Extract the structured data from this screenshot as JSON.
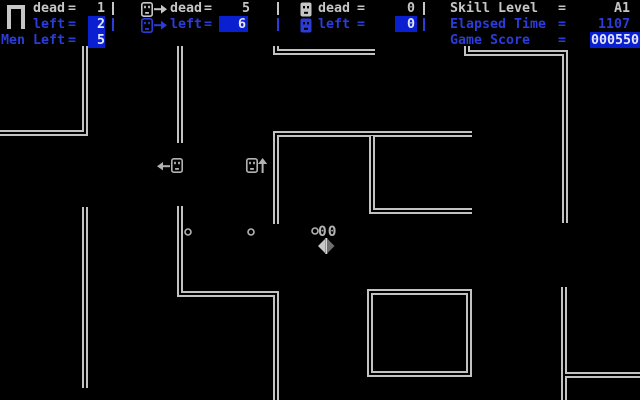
{
  "colors": {
    "background": "#000000",
    "wall": "#c2c2c2",
    "text_white": "#c6c6c6",
    "text_blue": "#2c3cd8",
    "highlight_bg": "#0a1fd0",
    "highlight_text": "#e2e6ff",
    "sprite": "#b2b2b2"
  },
  "header": {
    "separator": "|",
    "col_man": {
      "icon": "man-icon",
      "dead_label": "dead",
      "eq": "=",
      "dead_value": "1",
      "left_label": "left",
      "left_value": "2",
      "men_left_label": "Men Left",
      "men_left_value": "5"
    },
    "col_walker": {
      "icon": "walker-face-right-icon",
      "dead_label": "dead",
      "eq": "=",
      "dead_value": "5",
      "left_label": "left",
      "left_value": "6"
    },
    "col_ghost": {
      "icon": "solid-face-icon",
      "dead_label": "dead",
      "eq": "=",
      "dead_value": "0",
      "left_label": "left",
      "left_value": "0"
    },
    "col_stats": {
      "skill_label": "Skill Level",
      "eq": "=",
      "skill_value": "A1",
      "time_label": "Elapsed Time",
      "time_value": "1107",
      "score_label": "Game Score",
      "score_value": "000550"
    }
  },
  "maze": {
    "walls": [
      "M85 46 L85 133 L0 133",
      "M180 46 L180 143",
      "M276 46 L276 52 L375 52",
      "M467 46 L467 53 L565 53 L565 223",
      "M276 224 L276 134 L472 134",
      "M372 136 L372 211 L472 211",
      "M85 207 L85 388",
      "M180 206 L180 294 L276 294 L276 400",
      "M370 292 L469 292 L469 374 L370 374 Z",
      "M564 287 L564 400",
      "M564 375 L640 375"
    ],
    "enemies": [
      {
        "dir": "left",
        "arrow_x": 157,
        "arrow_y": 161,
        "face_x": 171,
        "face_y": 158
      },
      {
        "dir": "up",
        "face_x": 246,
        "face_y": 158,
        "arrow_x": 258,
        "arrow_y": 158
      }
    ],
    "dots": [
      {
        "cx": 188,
        "cy": 232
      },
      {
        "cx": 251,
        "cy": 232
      },
      {
        "cx": 315,
        "cy": 231
      }
    ],
    "popup": {
      "text": "00",
      "x": 318,
      "y": 224
    },
    "diamond": {
      "x": 318,
      "y": 238
    }
  }
}
